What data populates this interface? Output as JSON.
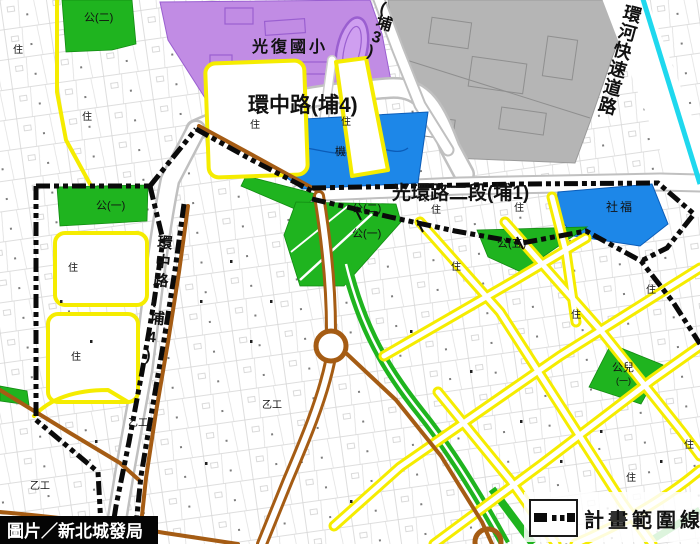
{
  "meta": {
    "kind": "urban-planning-map",
    "width": 700,
    "height": 544
  },
  "labels": {
    "school": "光復國小",
    "road_ring_h": "環中路(埔4)",
    "road_ring_v": "環中路(埔4)",
    "road_pu3": "(埔3)",
    "road_guanghuan": "光環路二段(埔1)",
    "expressway": "環河快速道路",
    "park_1": "公(一)",
    "park_2": "公(二)",
    "park_5": "公(五)",
    "park_child": "公兒",
    "park_child_sub": "(一)",
    "social_welfare": "社福",
    "agency": "機",
    "residential": "住",
    "industrial": "乙工"
  },
  "legend": {
    "line_label": "計畫範圍線"
  },
  "caption": {
    "credit": "圖片／新北城發局"
  },
  "colors": {
    "school_purple": "#c18ce4",
    "zone_blue": "#1d87e8",
    "park_green": "#1fb41f",
    "road_yellow": "#f5ec00",
    "road_brown": "#a55c14",
    "river_cyan": "#1fd8ee",
    "industrial_gray": "#b5b5b5",
    "boundary_black": "#0a0a0a"
  }
}
